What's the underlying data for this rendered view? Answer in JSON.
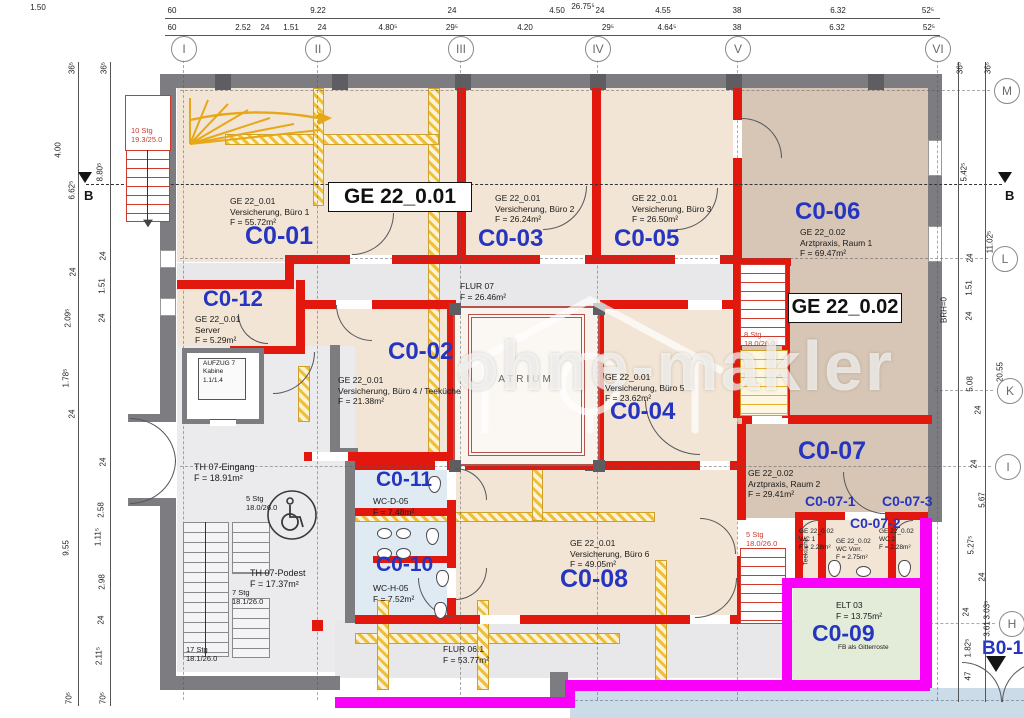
{
  "watermark": {
    "text": "ohne-makler"
  },
  "zone_boxes": {
    "ge1": "GE 22_0.01",
    "ge2": "GE 22_0.02"
  },
  "grid": {
    "top": [
      "I",
      "II",
      "III",
      "IV",
      "V",
      "VI"
    ],
    "right": [
      "M",
      "L",
      "K",
      "I",
      "H"
    ],
    "section": "B",
    "entry": "B0-1"
  },
  "dims": {
    "total": "26.75⁵",
    "corner": "1.50",
    "top1": [
      "60",
      "9.22",
      "24",
      "4.50",
      "24",
      "4.55",
      "38",
      "6.32",
      "52⁵"
    ],
    "top2": [
      "60",
      "2.52",
      "24",
      "1.51",
      "24",
      "4.80⁵",
      "29⁵",
      "4.20",
      "29⁵",
      "4.64⁵",
      "38",
      "6.32",
      "52⁵"
    ],
    "left": [
      "36⁵",
      "36⁵",
      "4.00",
      "6.62⁵",
      "8.80⁵",
      "24",
      "24",
      "1.51",
      "2.09⁵",
      "24",
      "1.78⁵",
      "24",
      "9.55",
      "24",
      "2.58",
      "1.11⁵",
      "2.98",
      "24",
      "2.11⁵",
      "70⁵",
      "70⁵"
    ],
    "right": [
      "36⁵",
      "36⁵",
      "5.42⁵",
      "11.02⁵",
      "24",
      "1.51",
      "24",
      "BRH=0",
      "20.55",
      "5.08",
      "24",
      "24",
      "5.67",
      "5.27⁵",
      "24",
      "24",
      "3.03⁵",
      "3.61",
      "1.82⁵",
      "47"
    ]
  },
  "rooms": {
    "c0_01": {
      "id": "C0-01",
      "desc": "GE 22_0.01\nVersicherung, Büro 1\nF = 55.72m²"
    },
    "c0_02": {
      "id": "C0-02",
      "desc": "GE 22_0.01\nVersicherung, Büro 4 / Teeküche\nF = 21.38m²"
    },
    "c0_03": {
      "id": "C0-03",
      "desc": "GE 22_0.01\nVersicherung, Büro 2\nF = 26.24m²"
    },
    "c0_04": {
      "id": "C0-04",
      "desc": "GE 22_0.01\nVersicherung, Büro 5\nF = 23.62m²"
    },
    "c0_05": {
      "id": "C0-05",
      "desc": "GE 22_0.01\nVersicherung, Büro 3\nF = 26.50m²"
    },
    "c0_06": {
      "id": "C0-06",
      "desc": "GE 22_0.02\nArztpraxis, Raum 1\nF = 69.47m²"
    },
    "c0_07": {
      "id": "C0-07",
      "desc": "GE 22_0.02\nArztpraxis, Raum 2\nF = 29.41m²"
    },
    "c0_07_1": {
      "id": "C0-07-1",
      "desc": "GE 22_0.02\nWC 1\nF = 2.28m²"
    },
    "c0_07_2": {
      "id": "C0-07-2",
      "desc": "GE 22_0.02\nWC Vorr.\nF = 2.75m²"
    },
    "c0_07_3": {
      "id": "C0-07-3",
      "desc": "GE 22_0.02\nWC 2\nF = 2.28m²"
    },
    "c0_08": {
      "id": "C0-08",
      "desc": "GE 22_0.01\nVersicherung, Büro 6\nF = 49.05m²"
    },
    "c0_09": {
      "id": "C0-09",
      "desc": "ELT 03\nF = 13.75m²",
      "note": "FB als Gitterroste"
    },
    "c0_10": {
      "id": "C0-10",
      "desc": "WC-H-05\nF = 7.52m²"
    },
    "c0_11": {
      "id": "C0-11",
      "desc": "WC-D-05\nF = 7.48m²"
    },
    "c0_12": {
      "id": "C0-12",
      "desc": "GE 22_0.01\nServer\nF = 5.29m²"
    },
    "flur07": {
      "desc": "FLUR 07\nF = 26.46m²"
    },
    "flur061": {
      "desc": "FLUR 06.1\nF = 53.77m²"
    },
    "th_eingang": {
      "desc": "TH 07-Eingang\nF = 18.91m²"
    },
    "th_podest": {
      "desc": "TH 07-Podest\nF = 17.37m²"
    },
    "aufzug": {
      "desc": "AUFZUG 7\nKabine\n1.1/1.4"
    },
    "atrium": {
      "id": "ATRIUM"
    },
    "b0_1": {
      "id": "B0-1"
    },
    "teekueche": {
      "id": "Teeküche"
    }
  },
  "stairs": {
    "s1": "10 Stg\n19.3/25.0",
    "s2": "5 Stg\n18.0/26.0",
    "s3": "7 Stg\n18.1/26.0",
    "s4": "17 Stg\n18.1/26.0",
    "s5": "8 Stg\n18.0/26.0",
    "s6": "5 Stg\n18.0/26.0"
  },
  "colors": {
    "wall_red": "#e2180f",
    "wall_yellow": "#f0bf3a",
    "wall_gray": "#7d7d81",
    "boundary_magenta": "#f900f9",
    "label_blue": "#2535c0",
    "wc_blue": "#dfeaf3",
    "elt_green": "#e2ecd9",
    "room_cream": "#f2e5d5",
    "room_tan": "#d7c6b5"
  }
}
